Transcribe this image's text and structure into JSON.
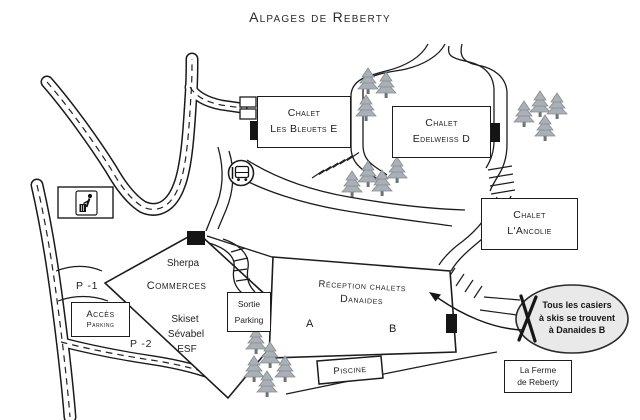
{
  "title": "Alpages de Reberty",
  "chalets": {
    "bleuets": {
      "name": "Chalet",
      "sub": "Les Bleuets E"
    },
    "edelweiss": {
      "name": "Chalet",
      "sub": "Edelweiss D"
    },
    "ancolie": {
      "name": "Chalet",
      "sub": "L'Ancolie"
    },
    "reception": {
      "line1": "Réception chalets",
      "line2": "Danaides",
      "unit_a": "A",
      "unit_b": "B"
    },
    "piscine": "Piscine",
    "ferme": {
      "line1": "La Ferme",
      "line2": "de Reberty"
    }
  },
  "commerces": {
    "tenant_top": "Sherpa",
    "name": "Commerces",
    "tenants_bottom": [
      "Skiset",
      "Sévabel",
      "ESF"
    ]
  },
  "parking": {
    "acces_line1": "Accès",
    "acces_line2": "Parking",
    "sortie_line1": "Sortie",
    "sortie_line2": "Parking",
    "level1": "P -1",
    "level2": "P -2"
  },
  "callout": {
    "line1": "Tous les casiers",
    "line2": "à skis se trouvent",
    "line3": "à Danaides B"
  },
  "icons": {
    "bus_stop": "bus-stop-icon",
    "waste_point": "waste-disposal-icon",
    "ski_lockers": "crossed-skis-icon",
    "trees": "pine-tree-icon"
  },
  "colors": {
    "ink": "#1f1f1f",
    "tree_fill": "#aab0b6",
    "tree_outline": "#868c92",
    "tree_trunk": "#6e7276",
    "callout_fill": "#e9e9e9",
    "background": "#ffffff"
  }
}
